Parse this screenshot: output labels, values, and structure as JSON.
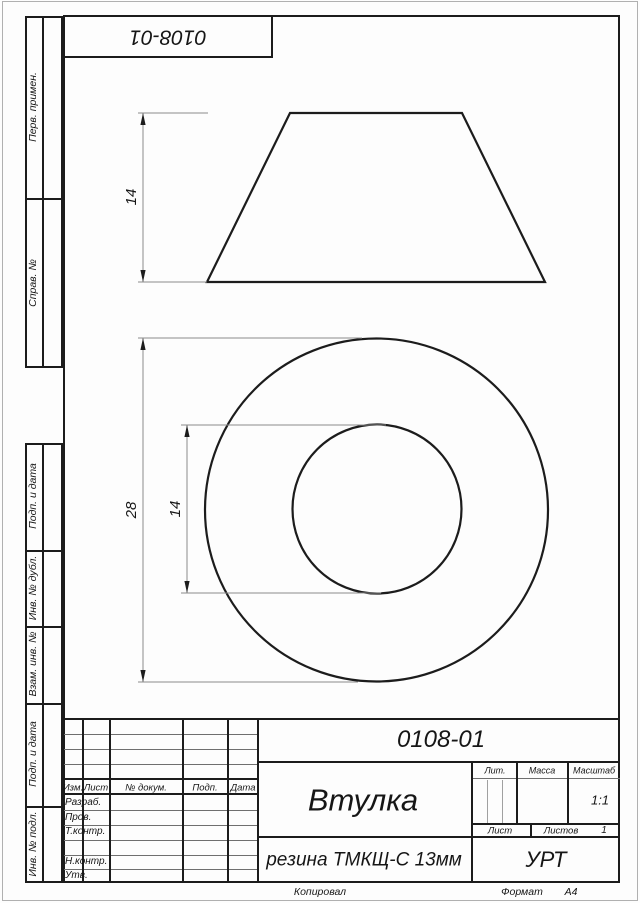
{
  "page": {
    "top_stamp": "0108-01",
    "footer": {
      "copied": "Копировал",
      "format_label": "Формат",
      "format_value": "А4"
    }
  },
  "margin": {
    "labels": [
      "Перв. примен.",
      "Справ. №",
      "Подп. и дата",
      "Инв. № дубл.",
      "Взам. инв. №",
      "Подп. и дата",
      "Инв. № подл."
    ]
  },
  "views": {
    "dims": {
      "front_height": "14",
      "outer_diameter": "28",
      "inner_diameter": "14"
    }
  },
  "title_block": {
    "designation": "0108-01",
    "part_name": "Втулка",
    "material": "резина ТМКЩ-С 13мм",
    "organization": "УРТ",
    "change_table_headers": [
      "Изм.",
      "Лист",
      "№ докум.",
      "Подп.",
      "Дата"
    ],
    "signature_rows": [
      "Разраб.",
      "Пров.",
      "Т.контр.",
      "Н.контр.",
      "Утв."
    ],
    "lit_label": "Лит.",
    "mass_label": "Масса",
    "scale_label": "Масштаб",
    "scale_value": "1:1",
    "sheet_label": "Лист",
    "sheets_label": "Листов",
    "sheets_value": "1"
  }
}
